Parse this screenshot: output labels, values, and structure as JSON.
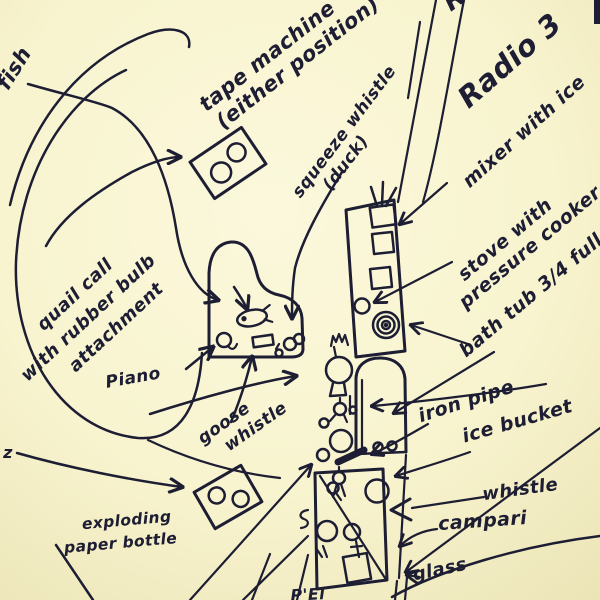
{
  "diagram": {
    "description": "hand-drawn stage plan of instruments and props",
    "colors": {
      "paper": "#f8f4cf",
      "ink": "#1d1d33"
    },
    "labels": {
      "fish": "fish",
      "tape_machine_line1": "tape machine",
      "tape_machine_line2": "(either position)",
      "squeeze_whistle_line1": "squeeze whistle",
      "squeeze_whistle_line2": "(duck)",
      "radio_cutoff": "R",
      "radio_3": "Radio 3",
      "mixer": "mixer with ice",
      "stove_line1": "stove with",
      "stove_line2": "pressure cooker",
      "bath_tub": "bath tub 3/4 full",
      "quail_line1": "quail call",
      "quail_line2": "with rubber bulb",
      "quail_line3": "attachment",
      "piano": "Piano",
      "goose_line1": "goose",
      "goose_line2": "whistle",
      "iron_pipe": "iron pipe",
      "ice_bucket": "ice bucket",
      "whistle": "whistle",
      "campari": "campari",
      "glass": "glass",
      "exploding_line1": "exploding",
      "exploding_line2": "paper bottle",
      "left_edge_mark": "z",
      "bottom_cutoff": "P'El"
    },
    "drawn_objects": [
      "tape-machine-reel-box (two positions)",
      "grand-piano outline with fish, quail-call, goose-whistle and small whistles on it",
      "tall table with mixer, radios, burner-spiral (stove with pressure cooker)",
      "bath-tub arch with two drains",
      "iron-pipe thick bar",
      "lower table with ice bucket, whistle, campari bottle and glass",
      "cluster of small whistle doodles at performer position",
      "leader arrows radiating from labels to objects"
    ]
  }
}
